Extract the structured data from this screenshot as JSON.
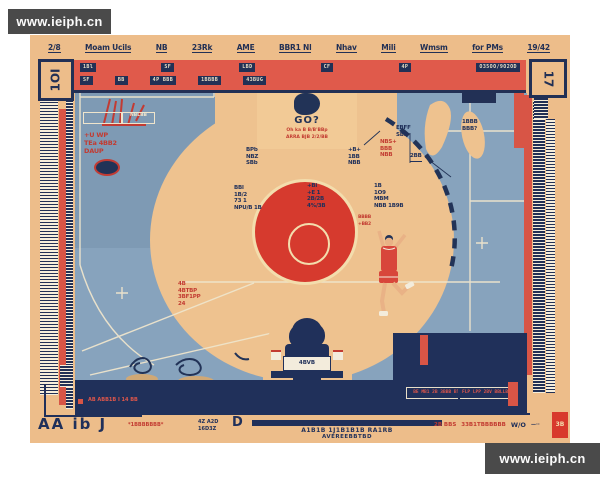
{
  "watermark_top_left": "www.ieiph.cn",
  "watermark_bottom_right": "www.ieiph.cn",
  "colors": {
    "poster_tan": "#edbd8a",
    "court_blue": "#87a3bd",
    "navy": "#20305a",
    "header_coral": "#e05a4b",
    "center_red": "#d63a2e",
    "ring_cream": "#f3ddad",
    "watermark_bg": "#4a4a4a"
  },
  "top_row": [
    "2/8",
    "Moam Ucils",
    "NB",
    "23Rk",
    "AME",
    "BBR1 Nl",
    "Nhav",
    "Mili",
    "Wmsm",
    "for PMs",
    "19/42"
  ],
  "corner_top_left": "1OI",
  "corner_top_right": "17",
  "header": {
    "row1": [
      "1Bl",
      "SF",
      "LBD",
      "CF",
      "4P",
      "O35OO/9O2OD"
    ],
    "row2": [
      "SF",
      "BB",
      "4P BBB",
      "1BBBB",
      "43BUG"
    ]
  },
  "badge": {
    "tab": "1BBB2",
    "title": "GO?",
    "line1": "Oh ka B B/B'BBp",
    "line2": "ARRA BJB 2/2/BB"
  },
  "clusters": {
    "key_left": [
      "BPb",
      "NBZ",
      "SBb"
    ],
    "key_right": [
      "+B+",
      "1BB",
      "NBB"
    ],
    "key_red": [
      "NBS+",
      "BBB",
      "NBB"
    ],
    "circle_left": [
      "BBl",
      "1B/2",
      "73 1",
      "NPU/B 1B"
    ],
    "circle_mid": [
      "+Bi",
      "+E 1",
      "2B/2B",
      "4%/3B"
    ],
    "circle_right": [
      "1B",
      "1O9",
      "MBM",
      "NBB 1B9B"
    ],
    "arc_note": [
      "EBFF",
      "SBB"
    ],
    "arc_note2": [
      "2BB"
    ],
    "blob_note": [
      "1BBB",
      "BBB?"
    ],
    "player_note": [
      "BBBB",
      "+BB2"
    ],
    "lower_red": [
      "4B",
      "4BTBP",
      "3BF1PP",
      "24"
    ],
    "scribble_red": [
      "+U WP",
      "TEa 4BB2",
      "DAUP"
    ],
    "white_box_label": [
      "NBLBB"
    ]
  },
  "navy_box_text": "BE MB1 2B 3BBB BT FLP LPP 2BV BBLLBB",
  "arch_panel": "4BVB",
  "bottom": {
    "red_small": "AB ABB1B I 14 BB",
    "big_left": "AA ib J",
    "left_red": "*1BBBBBBB*",
    "mini1": "4Z A2D",
    "mini2": "16D3Z",
    "ring": "D",
    "line1": "A1B1B 1J1B1B1B RA1RB",
    "line2": "AVEREEBBTBD",
    "right1": "2B BBS",
    "right2": "33B1TBBBBBB",
    "right3": "W/O",
    "dots": "—··",
    "corner_glyph": "3B"
  }
}
